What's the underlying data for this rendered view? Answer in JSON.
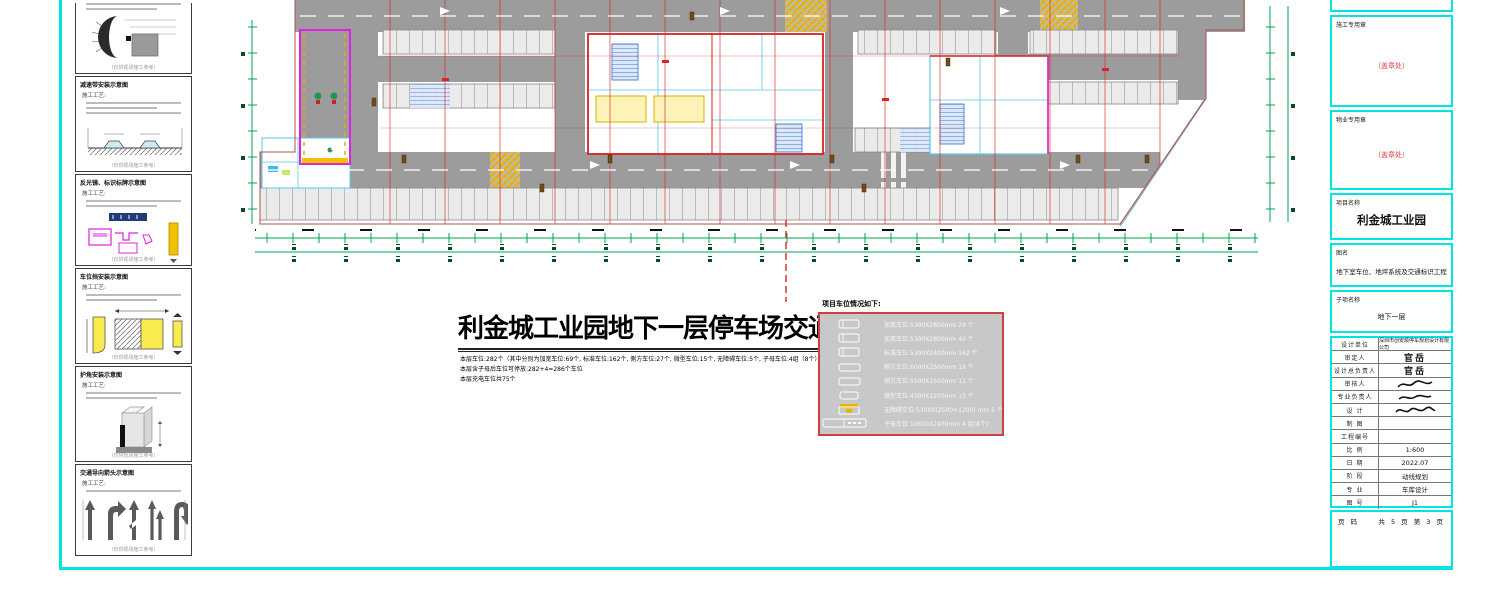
{
  "left_panels": {
    "note_label": "施工工艺:",
    "caption": "（仅供现场施工参考）",
    "panels": [
      {
        "title": ""
      },
      {
        "title": "减速带安装示意图"
      },
      {
        "title": "反光镜、标识标牌示意图"
      },
      {
        "title": "车位挡安装示意图"
      },
      {
        "title": "护角安装示意图"
      },
      {
        "title": "交通导向箭头示意图"
      }
    ]
  },
  "main": {
    "title": "利金城工业园地下一层停车场交通设施平面图",
    "notes": [
      "本层车位:282个（其中分别为加宽车位:69个, 标准车位:162个, 侧方车位:27个, 微型车位:15个, 无障碍车位:5个, 子母车位:4组（8个））",
      "本层含子母后车位可停放:282+4=286个车位",
      "本层充电车位共75个"
    ]
  },
  "legend": {
    "title": "项目车位情况如下:",
    "rows": [
      {
        "icon": "widened-stall-icon",
        "label": "加宽车位:5300X2800mm 29 个"
      },
      {
        "icon": "widened-stall-icon",
        "label": "加宽车位:5300X2800mm 40 个"
      },
      {
        "icon": "standard-stall-icon",
        "label": "标准车位:5300X2400mm 162 个"
      },
      {
        "icon": "side-stall-icon",
        "label": "侧方车位:6000X2500mm 16 个"
      },
      {
        "icon": "side-stall-icon",
        "label": "侧方车位:5500X2500mm 11 个"
      },
      {
        "icon": "mini-stall-icon",
        "label": "微型车位:4300X2200mm 15 个"
      },
      {
        "icon": "accessible-stall-icon",
        "label": "无障碍车位:5300X(2500+1200) mm 5 个"
      },
      {
        "icon": "tandem-stall-icon",
        "label": "子母车位:10600X2400mm 4 组(8个)"
      }
    ]
  },
  "title_block": {
    "stamps": [
      {
        "label": "施工专用章",
        "placeholder": "（盖章处）"
      },
      {
        "label": "物业专用章",
        "placeholder": "（盖章处）"
      }
    ],
    "project": {
      "label": "项目名称",
      "value": "利金城工业园"
    },
    "drawing": {
      "label": "图名",
      "value": "地下室车位、地坪系统及交通标识工程"
    },
    "subitem": {
      "label": "子项名称",
      "value": "地下一层"
    },
    "rows": [
      {
        "label": "设计单位",
        "value": "深圳市创安顺停车规划设计有限公司"
      },
      {
        "label": "审定人",
        "value": "官岳"
      },
      {
        "label": "设计总负责人",
        "value": "官岳"
      },
      {
        "label": "审核人",
        "value": ""
      },
      {
        "label": "专业负责人",
        "value": ""
      },
      {
        "label": "设 计",
        "value": ""
      },
      {
        "label": "制 图",
        "value": ""
      },
      {
        "label": "工程编号",
        "value": ""
      },
      {
        "label": "比 例",
        "value": "1:600"
      },
      {
        "label": "日 期",
        "value": "2022.07"
      },
      {
        "label": "阶 段",
        "value": "动线规划"
      },
      {
        "label": "专 业",
        "value": "车库设计"
      },
      {
        "label": "图 号",
        "value": "J1"
      }
    ],
    "page": {
      "label": "页 码",
      "value": "共 5 页 第 3 页"
    }
  },
  "colors": {
    "frame": "#00e4e4",
    "axis_green": "#00a550",
    "grid_red": "#dd2222",
    "ramp_magenta": "#e020e0",
    "room_cyan": "#57c8e8",
    "crossing_yellow": "#f0a800",
    "legend_border_red": "#cc4040"
  }
}
